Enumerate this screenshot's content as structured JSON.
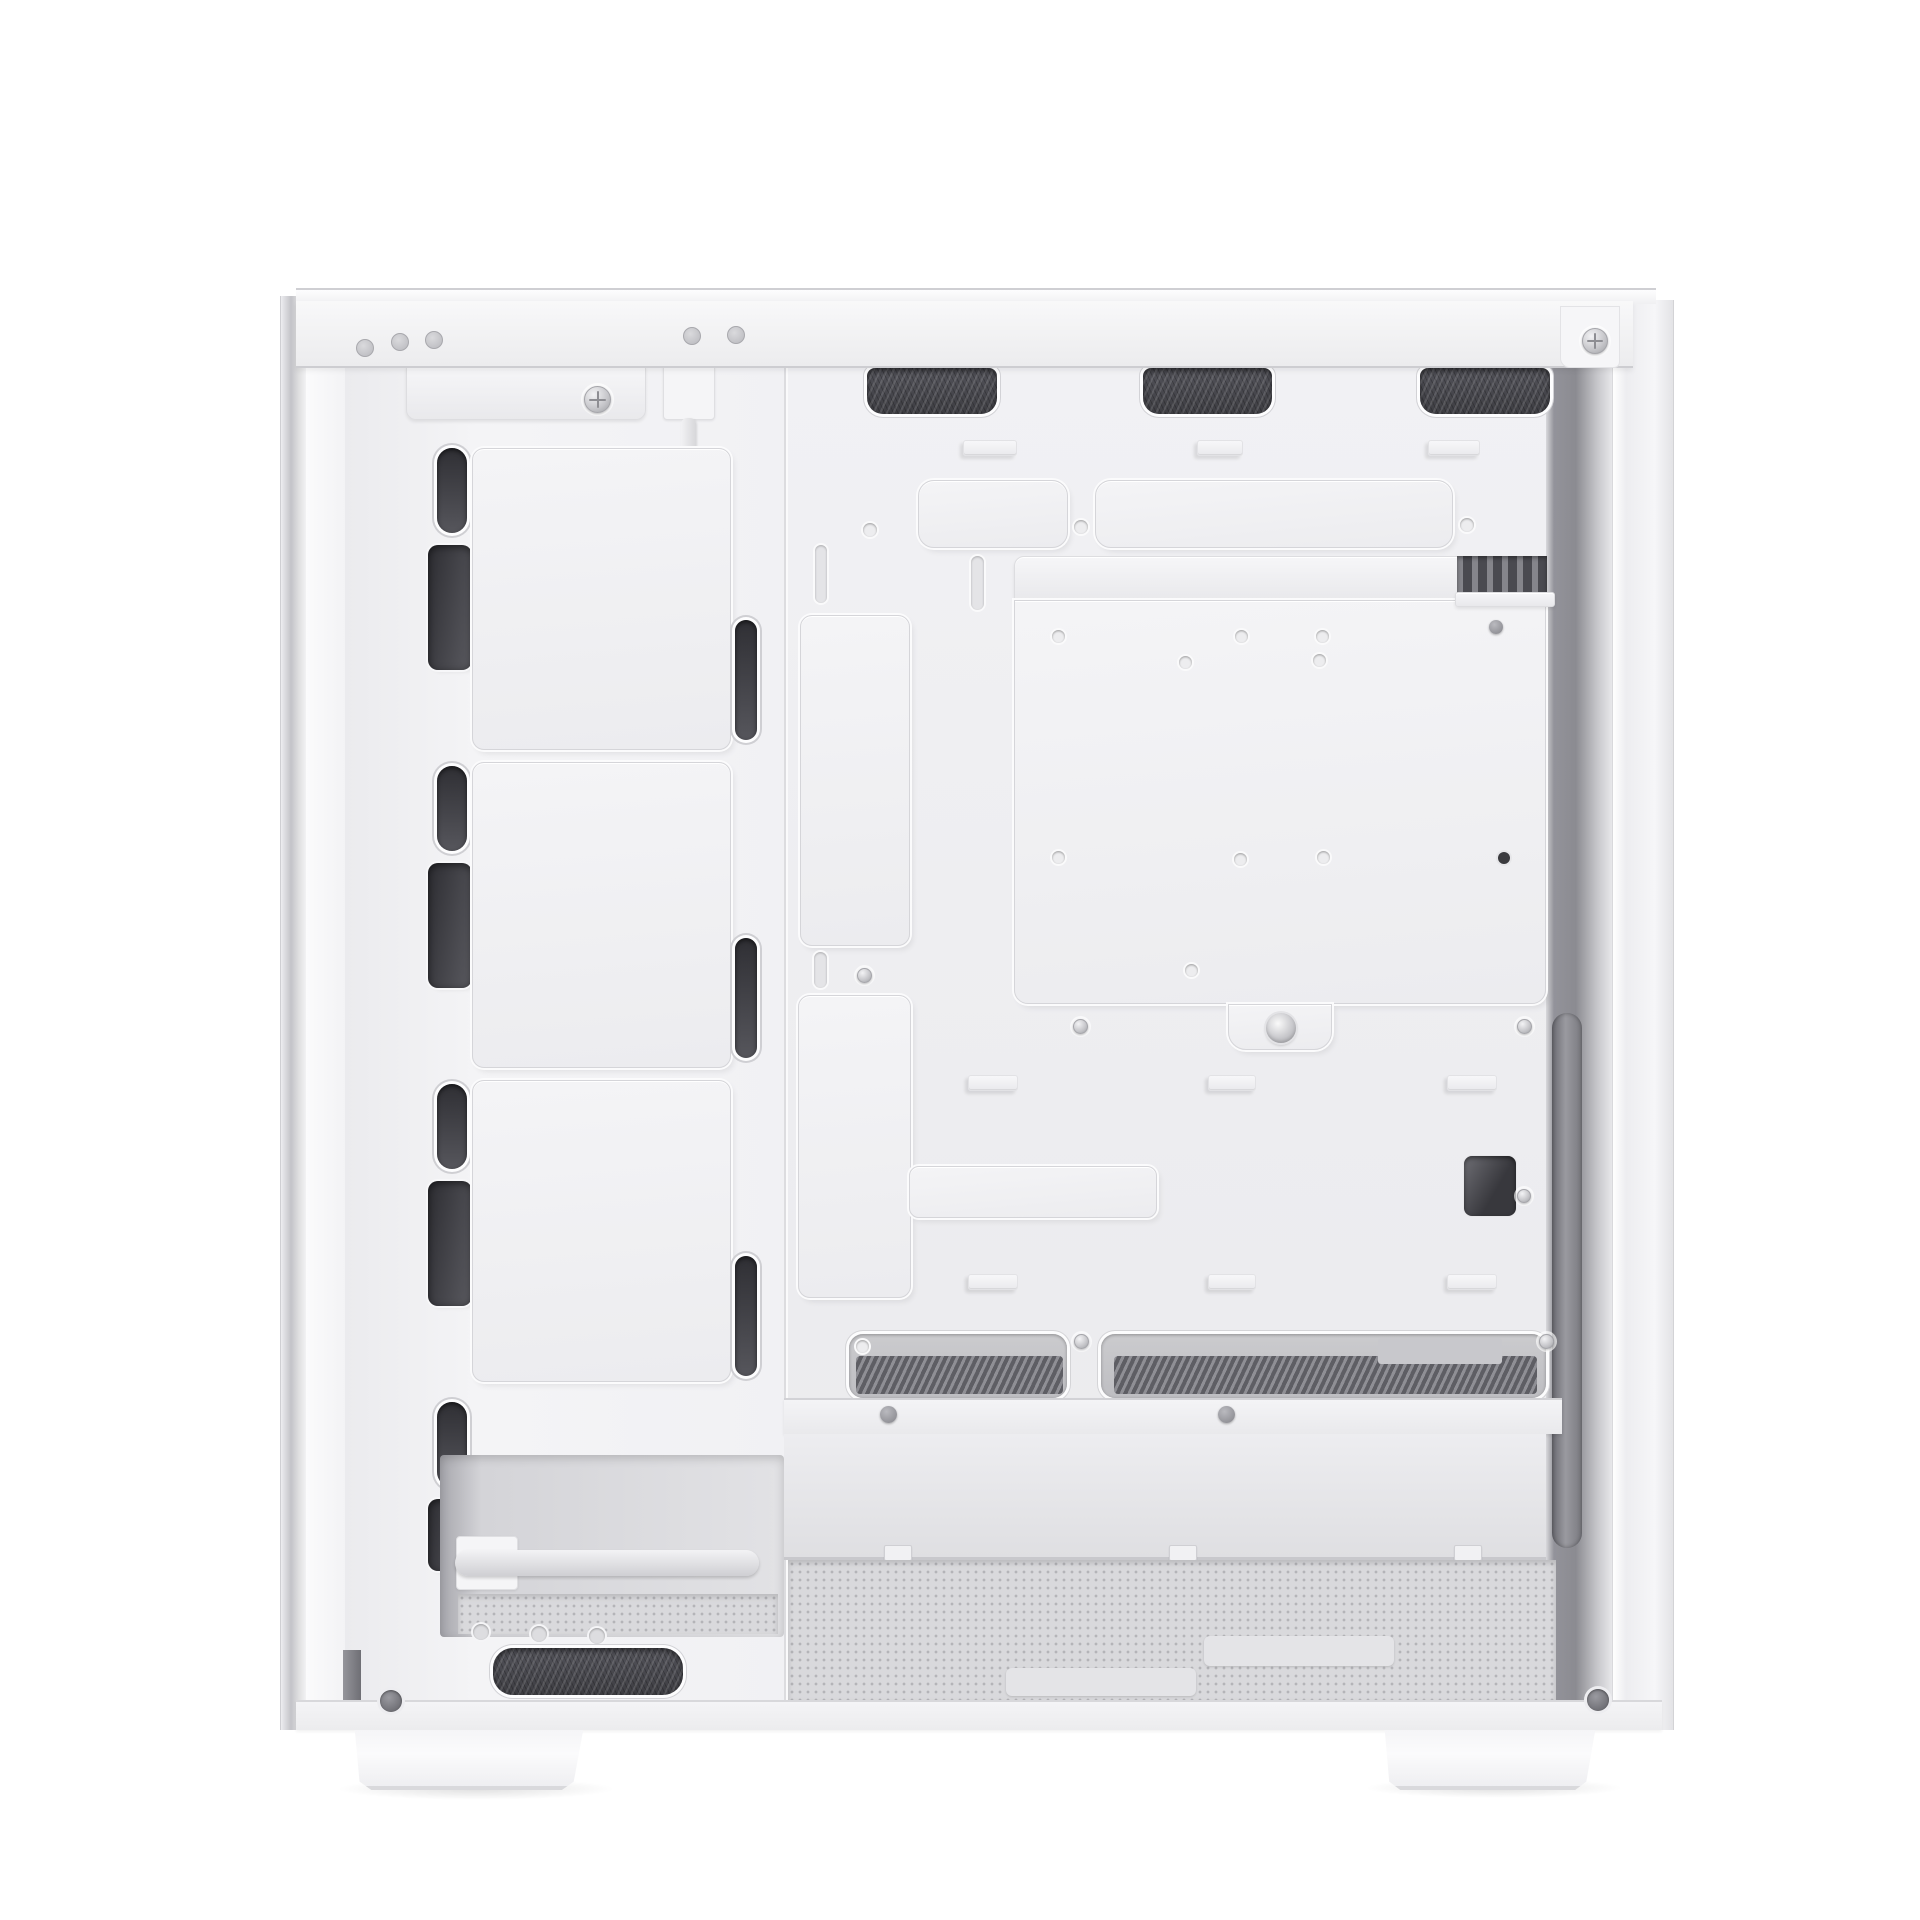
{
  "meta": {
    "description": "Product photo of a white ATX PC tower case, side panel removed, interior view",
    "background": "#ffffff",
    "canvas": {
      "width": 1920,
      "height": 1920
    }
  },
  "palette": {
    "body_white": "#f2f2f4",
    "panel_shadow": "#d5d5d9",
    "mesh_dark": "#3d3d42",
    "slot_dark": "#2f2f34",
    "interior_shadow": "#8b8b91",
    "floor_mesh": "#d9d9dc",
    "metal_screw": "#c5c5c9"
  },
  "parts": [
    {
      "n": "left-foot-shadow",
      "c": "shadow-ellipse",
      "b": [
        336,
        1778,
        280,
        22
      ]
    },
    {
      "n": "right-foot-shadow",
      "c": "shadow-ellipse",
      "b": [
        1364,
        1778,
        260,
        20
      ]
    },
    {
      "n": "front-outer-edge",
      "c": "left-edge",
      "b": [
        280,
        296,
        26,
        1434
      ]
    },
    {
      "n": "front-edge-white-strip",
      "c": "left-white",
      "b": [
        306,
        296,
        40,
        1434
      ]
    },
    {
      "n": "front-panel-column",
      "c": "front-col",
      "b": [
        345,
        368,
        440,
        1332
      ]
    },
    {
      "n": "motherboard-tray",
      "c": "tray",
      "b": [
        784,
        368,
        762,
        1332
      ]
    },
    {
      "n": "right-interior-shadow",
      "c": "right-shadow",
      "b": [
        1546,
        368,
        66,
        1332
      ]
    },
    {
      "n": "right-outer-wall",
      "c": "outer-wall",
      "b": [
        1612,
        300,
        62,
        1430
      ]
    },
    {
      "n": "front-top-bracket",
      "c": "bar-light",
      "b": [
        406,
        366,
        240,
        54
      ],
      "r": "0 0 10px 10px"
    },
    {
      "n": "bracket-screw",
      "c": "screw screw-ph",
      "b": [
        584,
        386,
        27,
        27
      ]
    },
    {
      "n": "front-cable-connector",
      "c": "light-block",
      "b": [
        663,
        360,
        52,
        60
      ]
    },
    {
      "n": "front-panel-cable",
      "c": "cable",
      "b": [
        681,
        418,
        15,
        186
      ]
    },
    {
      "n": "cable-plug-tip",
      "c": "cable-tip",
      "b": [
        677,
        596,
        22,
        46
      ]
    },
    {
      "n": "top-vent-mesh-1",
      "c": "mesh-dark mesh-top",
      "b": [
        867,
        368,
        130,
        46
      ]
    },
    {
      "n": "top-vent-mesh-2",
      "c": "mesh-dark mesh-top",
      "b": [
        1143,
        368,
        129,
        46
      ]
    },
    {
      "n": "top-vent-mesh-3",
      "c": "mesh-dark mesh-top",
      "b": [
        1420,
        368,
        130,
        46
      ]
    },
    {
      "n": "front-slot-pill-1",
      "c": "pill",
      "b": [
        437,
        448,
        30,
        85
      ]
    },
    {
      "n": "front-slot-pill-2",
      "c": "pill",
      "b": [
        437,
        766,
        30,
        85
      ]
    },
    {
      "n": "front-slot-pill-3",
      "c": "pill",
      "b": [
        437,
        1084,
        30,
        85
      ]
    },
    {
      "n": "front-slot-pill-4",
      "c": "pill",
      "b": [
        437,
        1402,
        30,
        85
      ]
    },
    {
      "n": "front-slot-wide-1",
      "c": "wide-slot",
      "b": [
        428,
        545,
        44,
        125
      ]
    },
    {
      "n": "front-slot-wide-2",
      "c": "wide-slot",
      "b": [
        428,
        863,
        44,
        125
      ]
    },
    {
      "n": "front-slot-wide-3",
      "c": "wide-slot",
      "b": [
        428,
        1181,
        44,
        125
      ]
    },
    {
      "n": "front-slot-wide-4",
      "c": "wide-slot",
      "b": [
        428,
        1499,
        44,
        72
      ]
    },
    {
      "n": "front-fan-plate-1",
      "c": "plate",
      "b": [
        472,
        448,
        259,
        302
      ]
    },
    {
      "n": "front-fan-plate-2",
      "c": "plate",
      "b": [
        472,
        762,
        259,
        306
      ]
    },
    {
      "n": "front-fan-plate-3",
      "c": "plate",
      "b": [
        472,
        1080,
        259,
        302
      ]
    },
    {
      "n": "fan-plate-right-pill-1",
      "c": "pill",
      "b": [
        735,
        620,
        22,
        120
      ]
    },
    {
      "n": "fan-plate-right-pill-2",
      "c": "pill",
      "b": [
        735,
        938,
        22,
        120
      ]
    },
    {
      "n": "fan-plate-right-pill-3",
      "c": "pill",
      "b": [
        735,
        1256,
        22,
        120
      ]
    },
    {
      "n": "cable-tie-tab-1",
      "c": "tab",
      "b": [
        963,
        440,
        54,
        16
      ]
    },
    {
      "n": "cable-tie-tab-2",
      "c": "tab",
      "b": [
        1197,
        440,
        46,
        16
      ]
    },
    {
      "n": "cable-tie-tab-3",
      "c": "tab",
      "b": [
        1428,
        440,
        52,
        16
      ]
    },
    {
      "n": "grommet-cover-plate-small",
      "c": "plate",
      "b": [
        918,
        480,
        150,
        68
      ],
      "r": "16px"
    },
    {
      "n": "grommet-cover-plate-long",
      "c": "plate",
      "b": [
        1095,
        480,
        358,
        68
      ],
      "r": "16px"
    },
    {
      "n": "tray-hole-1",
      "c": "hole",
      "b": [
        863,
        523,
        14,
        14
      ]
    },
    {
      "n": "tray-hole-2",
      "c": "hole",
      "b": [
        1074,
        520,
        14,
        14
      ]
    },
    {
      "n": "tray-hole-3",
      "c": "hole",
      "b": [
        1460,
        518,
        14,
        14
      ]
    },
    {
      "n": "tray-vslot-1",
      "c": "vslot",
      "b": [
        815,
        545,
        12,
        58
      ]
    },
    {
      "n": "tray-vslot-2",
      "c": "vslot",
      "b": [
        971,
        556,
        13,
        54
      ]
    },
    {
      "n": "cable-cover-plate-upper",
      "c": "plate",
      "b": [
        800,
        615,
        110,
        331
      ]
    },
    {
      "n": "tray-vslot-3",
      "c": "vslot",
      "b": [
        814,
        952,
        13,
        36
      ]
    },
    {
      "n": "tray-screw-1",
      "c": "screw",
      "b": [
        857,
        968,
        15,
        15
      ]
    },
    {
      "n": "cable-cover-plate-lower",
      "c": "plate",
      "b": [
        798,
        995,
        113,
        303
      ]
    },
    {
      "n": "cable-cover-arm-plate",
      "c": "plate",
      "b": [
        909,
        1166,
        248,
        52
      ],
      "r": "10px"
    },
    {
      "n": "psu-bracket-bar",
      "c": "bar-light",
      "b": [
        1014,
        556,
        532,
        44
      ],
      "r": "10px 10px 0 0"
    },
    {
      "n": "psu-hdd-mount-plate",
      "c": "plate",
      "b": [
        1014,
        600,
        532,
        404
      ],
      "r": "0 0 14px 14px"
    },
    {
      "n": "psu-plate-notch-tab",
      "c": "plate",
      "b": [
        1228,
        1004,
        104,
        46
      ],
      "r": "0 0 18px 18px"
    },
    {
      "n": "thumbscrew",
      "c": "thumbscrew",
      "b": [
        1266,
        1013,
        30,
        30
      ]
    },
    {
      "n": "plate-hole-1",
      "c": "hole",
      "b": [
        1052,
        630,
        13,
        13
      ]
    },
    {
      "n": "plate-hole-2",
      "c": "hole",
      "b": [
        1235,
        630,
        13,
        13
      ]
    },
    {
      "n": "plate-hole-3",
      "c": "hole",
      "b": [
        1316,
        630,
        13,
        13
      ]
    },
    {
      "n": "plate-hole-4",
      "c": "hole",
      "b": [
        1179,
        656,
        13,
        13
      ]
    },
    {
      "n": "plate-hole-5",
      "c": "hole",
      "b": [
        1313,
        654,
        13,
        13
      ]
    },
    {
      "n": "plate-hole-6",
      "c": "hole",
      "b": [
        1052,
        851,
        13,
        13
      ]
    },
    {
      "n": "plate-hole-7",
      "c": "hole",
      "b": [
        1234,
        853,
        13,
        13
      ]
    },
    {
      "n": "plate-hole-8",
      "c": "hole",
      "b": [
        1317,
        851,
        13,
        13
      ]
    },
    {
      "n": "plate-hole-9",
      "c": "hole",
      "b": [
        1185,
        964,
        13,
        13
      ]
    },
    {
      "n": "plate-hole-dark",
      "c": "hole-dark",
      "b": [
        1498,
        852,
        12,
        12
      ]
    },
    {
      "n": "notch-screw-left",
      "c": "screw",
      "b": [
        1073,
        1019,
        15,
        15
      ]
    },
    {
      "n": "notch-screw-right",
      "c": "screw",
      "b": [
        1517,
        1019,
        15,
        15
      ]
    },
    {
      "n": "rear-top-vent-slats",
      "c": "slat-vent",
      "b": [
        1457,
        556,
        90,
        40
      ]
    },
    {
      "n": "rear-top-bar",
      "c": "bar-light",
      "b": [
        1455,
        592,
        100,
        15
      ],
      "r": "3px"
    },
    {
      "n": "rear-dome-screw",
      "c": "dome",
      "b": [
        1489,
        620,
        14,
        14
      ]
    },
    {
      "n": "rear-cutout",
      "c": "dark-rect",
      "b": [
        1464,
        1156,
        52,
        60
      ]
    },
    {
      "n": "rear-cutout-screw",
      "c": "screw",
      "b": [
        1517,
        1189,
        14,
        14
      ]
    },
    {
      "n": "right-vertical-bar",
      "c": "vbar",
      "b": [
        1552,
        1013,
        30,
        535
      ]
    },
    {
      "n": "mid-tab-1",
      "c": "tab",
      "b": [
        968,
        1075,
        50,
        16
      ]
    },
    {
      "n": "mid-tab-2",
      "c": "tab",
      "b": [
        1208,
        1075,
        48,
        16
      ]
    },
    {
      "n": "mid-tab-3",
      "c": "tab",
      "b": [
        1447,
        1075,
        50,
        16
      ]
    },
    {
      "n": "low-tab-1",
      "c": "tab",
      "b": [
        968,
        1274,
        50,
        16
      ]
    },
    {
      "n": "low-tab-2",
      "c": "tab",
      "b": [
        1208,
        1274,
        48,
        16
      ]
    },
    {
      "n": "low-tab-3",
      "c": "tab",
      "b": [
        1447,
        1274,
        50,
        16
      ]
    },
    {
      "n": "shroud-vent-slot-left",
      "c": "mesh-slot",
      "b": [
        849,
        1334,
        218,
        64
      ]
    },
    {
      "n": "shroud-vent-slot-right",
      "c": "mesh-slot",
      "b": [
        1101,
        1334,
        445,
        64
      ]
    },
    {
      "n": "shroud-slot-light-patch",
      "c": "patch-light",
      "b": [
        1378,
        1338,
        124,
        26
      ]
    },
    {
      "n": "shroud-slot-hole",
      "c": "hole",
      "b": [
        856,
        1340,
        13,
        13
      ]
    },
    {
      "n": "shroud-slot-screw-mid",
      "c": "screw",
      "b": [
        1074,
        1334,
        15,
        15
      ]
    },
    {
      "n": "shroud-slot-screw-right",
      "c": "screw",
      "b": [
        1539,
        1334,
        15,
        15
      ]
    },
    {
      "n": "shroud-front-band",
      "c": "band",
      "b": [
        784,
        1398,
        778,
        36
      ]
    },
    {
      "n": "shroud-rivet-1",
      "c": "dome",
      "b": [
        880,
        1406,
        17,
        17
      ]
    },
    {
      "n": "shroud-rivet-2",
      "c": "dome",
      "b": [
        1218,
        1406,
        17,
        17
      ]
    },
    {
      "n": "shroud-back-wall",
      "c": "wall",
      "b": [
        784,
        1434,
        762,
        126
      ]
    },
    {
      "n": "wall-clip-1",
      "c": "clip",
      "b": [
        884,
        1545,
        28,
        16
      ]
    },
    {
      "n": "wall-clip-2",
      "c": "clip",
      "b": [
        1169,
        1545,
        28,
        16
      ]
    },
    {
      "n": "wall-clip-3",
      "c": "clip",
      "b": [
        1454,
        1545,
        28,
        16
      ]
    },
    {
      "n": "bottom-floor-mesh",
      "c": "floor-mesh",
      "b": [
        788,
        1560,
        768,
        140
      ]
    },
    {
      "n": "psu-rail-pad-1",
      "c": "pad",
      "b": [
        1204,
        1636,
        190,
        30
      ]
    },
    {
      "n": "psu-rail-pad-2",
      "c": "pad",
      "b": [
        1006,
        1668,
        190,
        28
      ]
    },
    {
      "n": "front-bottom-recess",
      "c": "recess",
      "b": [
        440,
        1455,
        344,
        182
      ]
    },
    {
      "n": "rod-bracket",
      "c": "light-block",
      "b": [
        456,
        1536,
        62,
        54
      ]
    },
    {
      "n": "front-bottom-rod",
      "c": "rod",
      "b": [
        455,
        1550,
        304,
        26
      ]
    },
    {
      "n": "recess-floor-mesh",
      "c": "floor-mesh",
      "b": [
        458,
        1594,
        320,
        40
      ]
    },
    {
      "n": "standoff-1",
      "c": "standoff",
      "b": [
        473,
        1624,
        16,
        16
      ]
    },
    {
      "n": "standoff-2",
      "c": "standoff",
      "b": [
        531,
        1626,
        16,
        16
      ]
    },
    {
      "n": "standoff-3",
      "c": "standoff",
      "b": [
        589,
        1628,
        16,
        16
      ]
    },
    {
      "n": "front-bottom-mesh",
      "c": "mesh-dark",
      "b": [
        493,
        1648,
        190,
        47
      ],
      "r": "20px"
    },
    {
      "n": "front-edge-bottom-dark",
      "c": "dark-block",
      "b": [
        343,
        1650,
        18,
        73
      ]
    },
    {
      "n": "top-edge-lip",
      "c": "lip",
      "b": [
        296,
        288,
        1360,
        16
      ]
    },
    {
      "n": "top-rail",
      "c": "rail",
      "b": [
        296,
        301,
        1337,
        67
      ]
    },
    {
      "n": "top-rail-corner-tab",
      "c": "rail-tab",
      "b": [
        1560,
        306,
        60,
        62
      ]
    },
    {
      "n": "rail-rivet-1",
      "c": "rivet",
      "b": [
        356,
        339,
        18,
        18
      ]
    },
    {
      "n": "rail-rivet-2",
      "c": "rivet",
      "b": [
        391,
        333,
        18,
        18
      ]
    },
    {
      "n": "rail-rivet-3",
      "c": "rivet",
      "b": [
        425,
        331,
        18,
        18
      ]
    },
    {
      "n": "rail-rivet-4",
      "c": "rivet",
      "b": [
        683,
        327,
        18,
        18
      ]
    },
    {
      "n": "rail-rivet-5",
      "c": "rivet",
      "b": [
        727,
        326,
        18,
        18
      ]
    },
    {
      "n": "rail-screw-right",
      "c": "screw screw-ph",
      "b": [
        1582,
        328,
        26,
        26
      ]
    },
    {
      "n": "bottom-rail",
      "c": "rail2",
      "b": [
        296,
        1700,
        1366,
        30
      ]
    },
    {
      "n": "bottom-left-screw",
      "c": "dark-screw",
      "b": [
        380,
        1690,
        22,
        22
      ]
    },
    {
      "n": "bottom-right-screw",
      "c": "dark-screw",
      "b": [
        1587,
        1689,
        22,
        22
      ]
    },
    {
      "n": "left-foot",
      "c": "foot",
      "b": [
        350,
        1730,
        238,
        60
      ]
    },
    {
      "n": "right-foot",
      "c": "foot",
      "b": [
        1378,
        1730,
        224,
        60
      ]
    }
  ]
}
